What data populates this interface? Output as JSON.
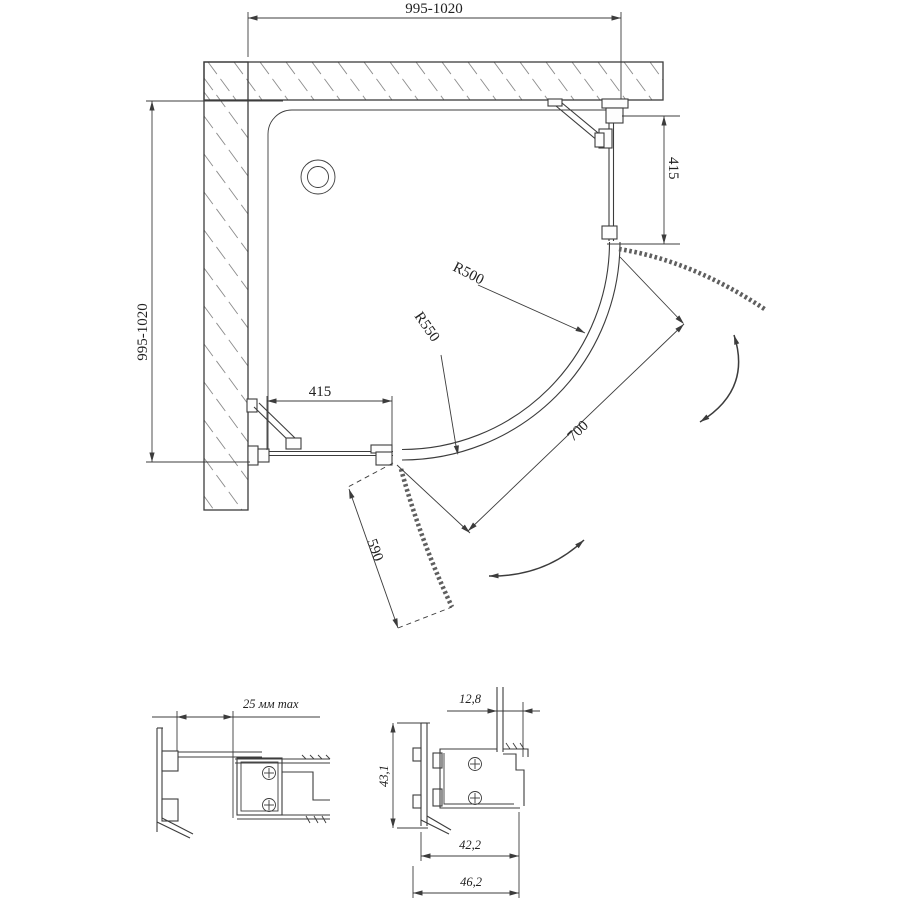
{
  "drawing": {
    "kind": "technical-dimension-diagram",
    "subject": "corner quarter-round shower enclosure, plan view with profile sections",
    "plan": {
      "width_top": "995-1020",
      "depth_left": "995-1020",
      "panel_right": "415",
      "panel_bottom": "415",
      "radius_inner": "R500",
      "radius_outer": "R550",
      "opening": "700",
      "door": "590"
    },
    "details": {
      "wall_gap": "25 мм max",
      "glass_offset": "12,8",
      "profile_height": "43,1",
      "width_inner": "42,2",
      "width_outer": "46,2"
    },
    "colors": {
      "line": "#3c3c3c",
      "hatch": "#8c8c8c",
      "background": "#ffffff"
    }
  }
}
